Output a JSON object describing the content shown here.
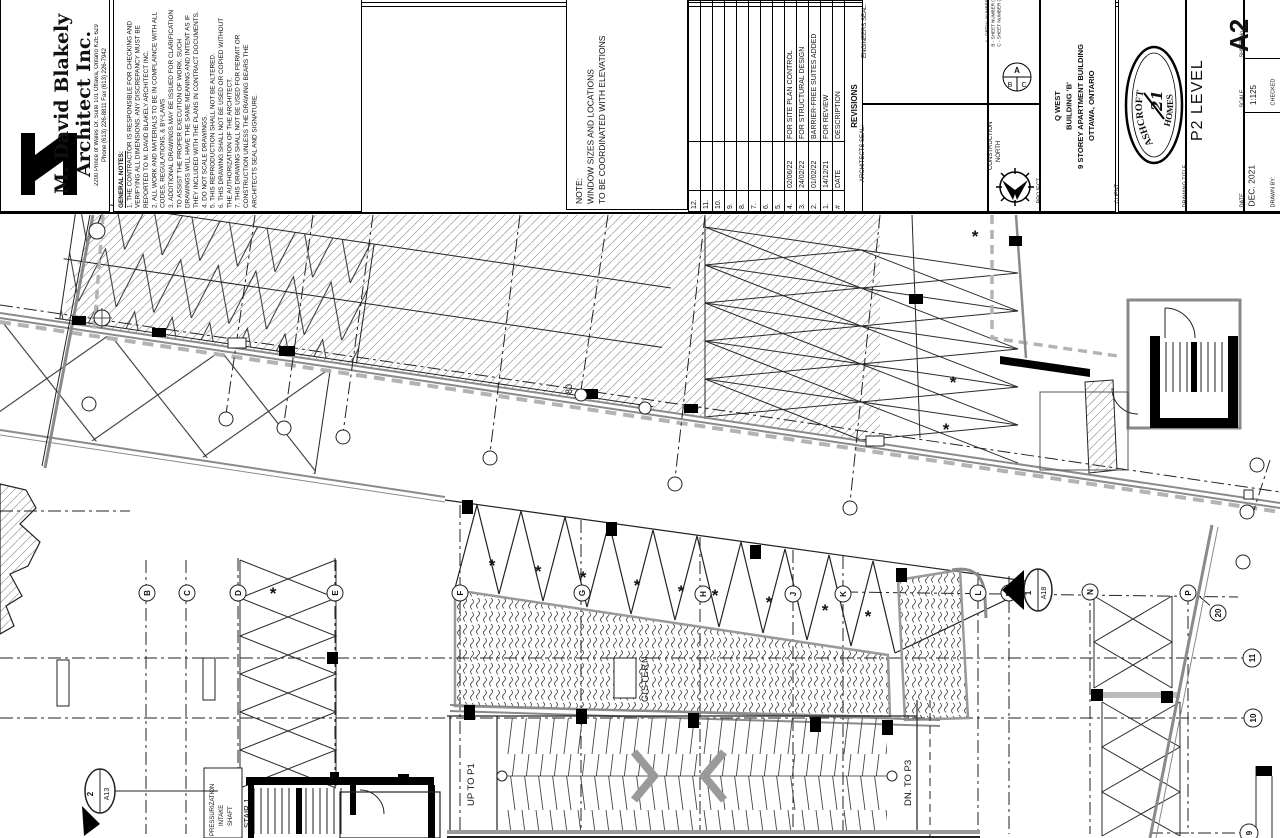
{
  "title_block": {
    "firm": {
      "name_line1": "M. David Blakely",
      "name_line2": "Architect Inc.",
      "address": "2200 Prince of Wales Dr. Suite 101 Ottawa, Ontario K2E 6Z9",
      "phone_fax": "Phone (613) 226-8811    Fax (613) 226-7942"
    },
    "general_notes": {
      "heading": "GENERAL NOTES:",
      "items": [
        {
          "num": "1.",
          "text": "THE CONTRACTOR IS RESPONSIBLE FOR CHECKING AND VERIFYING ALL DIMENSIONS. ANY DISCREPANCY MUST BE REPORTED TO M. DAVID BLAKELY ARCHITECT INC."
        },
        {
          "num": "2.",
          "text": "ALL WORK AND MATERIALS TO BE IN COMPLAINCE WITH ALL CODES, REGULATIONS, & BY-LAWS"
        },
        {
          "num": "3.",
          "text": "ADDITIONAL DRAWINGS MAY BE ISSUED FOR CLARIFICATION TO ASSIST THE PROPER EXECUTION OF WORK. SUCH DRAWINGS WILL HAVE THE SAME MEANING AND INTENT AS IF THEY INCLUDED WITH THE PLANS IN CONTRACT DOCUMENTS."
        },
        {
          "num": "4.",
          "text": "DO NOT SCALE DRAWINGS."
        },
        {
          "num": "5.",
          "text": "THIS REPRODUCTION SHALL NOT BE ALTERED."
        },
        {
          "num": "6.",
          "text": "THIS DRAWING SHALL NOT BE USED OR COPIED WITHOUT THE AUTHORIZATION OF THE ARCHITECT."
        },
        {
          "num": "7.",
          "text": "THIS DRAWING SHALL NOT BE USED FOR PERMIT OR CONSTRUCTION UNLESS THE DRAWING BEARS THE ARCHITECTS SEAL AND SIGNATURE."
        }
      ]
    },
    "note_box": {
      "heading": "NOTE:",
      "line1": "WINDOW SIZES AND LOCATIONS",
      "line2": "TO BE COORDINATED WITH ELEVATIONS"
    },
    "revisions": {
      "title": "REVISIONS",
      "headers": {
        "num": "#",
        "date": "DATE",
        "description": "DESCRIPTION"
      },
      "rows": [
        {
          "num": "12.",
          "date": "",
          "desc": ""
        },
        {
          "num": "11.",
          "date": "",
          "desc": ""
        },
        {
          "num": "10.",
          "date": "",
          "desc": ""
        },
        {
          "num": "9.",
          "date": "",
          "desc": ""
        },
        {
          "num": "8.",
          "date": "",
          "desc": ""
        },
        {
          "num": "7.",
          "date": "",
          "desc": ""
        },
        {
          "num": "6.",
          "date": "",
          "desc": ""
        },
        {
          "num": "5.",
          "date": "",
          "desc": ""
        },
        {
          "num": "4.",
          "date": "02/06/22",
          "desc": "FOR SITE PLAN CONTROL"
        },
        {
          "num": "3.",
          "date": "24/02/22",
          "desc": "FOR STRUCTURAL DESIGN"
        },
        {
          "num": "2.",
          "date": "01/02/22",
          "desc": "BARRIER-FREE SUITES ADDED"
        },
        {
          "num": "1.",
          "date": "14/12/21",
          "desc": "FOR REVIEW"
        }
      ]
    },
    "seals": {
      "engineers": "ENGINEERS SEAL:",
      "architects": "ARCHITECTS SEAL:"
    },
    "detail_legend": {
      "a": "A - DETAIL NUMBER",
      "b": "B - SHEET NUMBER (DETAIL REQ'D)",
      "c": "C - SHEET NUMBER (DETAIL LOCATION)",
      "circle_a": "A",
      "circle_b": "B",
      "circle_c": "C"
    },
    "north": {
      "label_line1": "CONSTRUCTION",
      "label_line2": "NORTH"
    },
    "project": {
      "label": "PROJECT",
      "line1": "Q WEST",
      "line2": "BUILDING 'B'",
      "line3": "9 STOREY APARTMENT BUILDING",
      "line4": "OTTAWA, ONTARIO"
    },
    "client": {
      "label": "CLIENT",
      "logo_top": "ASHCROFT",
      "logo_bottom": "HOMES",
      "logo_center": "21"
    },
    "drawing_title": {
      "label": "DRAWING TITLE",
      "value": "P2 LEVEL"
    },
    "sheet": {
      "label": "SHEET No.",
      "value": "A2"
    },
    "scale": {
      "label": "SCALE",
      "value": "1:125"
    },
    "date": {
      "label": "DATE",
      "value": "DEC. 2021"
    },
    "drawn_by_label": "DRAWN BY:",
    "checked_label": "CHECKED"
  },
  "plan": {
    "labels": {
      "cistern": "CISTERN",
      "up_ramp": "UP TO P1",
      "down_ramp": "DN. TO P3",
      "stair1": "STAIR 1",
      "press1": "PRESSURIZATION",
      "press2": "INTAKE",
      "press3": "SHAFT",
      "dim80": "80"
    },
    "stall_marker": "*",
    "bubbles": {
      "b": "B",
      "c": "C",
      "d": "D",
      "e": "E",
      "f": "F",
      "g": "G",
      "h": "H",
      "j": "J",
      "k": "K",
      "l": "L",
      "m": "M",
      "n": "N",
      "p": "P",
      "n9": "9",
      "n10": "10",
      "n11": "11",
      "n20": "20"
    },
    "sections": {
      "s1_num": "2",
      "s1_sheet": "A13",
      "s2_num": "1",
      "s2_sheet": "A18"
    }
  }
}
